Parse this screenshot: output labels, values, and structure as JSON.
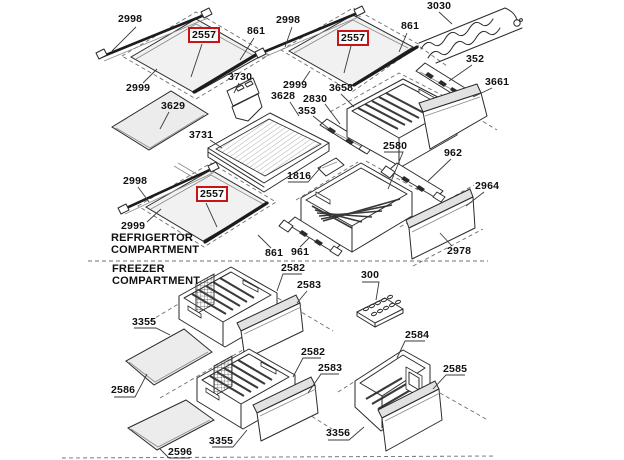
{
  "window": {
    "width": 624,
    "height": 460,
    "background": "#ffffff"
  },
  "diagram": {
    "type": "exploded-parts-diagram",
    "subject": "Refrigerator and freezer compartment shelves, drawers and trim parts",
    "line_color": "#2a2a2a",
    "highlight_color": "#c81414",
    "highlighted_part": "2557",
    "section_labels": [
      {
        "text": "REFRIGERTOR\nCOMPARTMENT",
        "x": 111,
        "y": 232
      },
      {
        "text": "FREEZER\nCOMPARTMENT",
        "x": 112,
        "y": 263
      }
    ],
    "part_labels": [
      {
        "text": "2998",
        "x": 118,
        "y": 14,
        "highlighted": false
      },
      {
        "text": "2557",
        "x": 188,
        "y": 27,
        "highlighted": true
      },
      {
        "text": "861",
        "x": 247,
        "y": 26,
        "highlighted": false
      },
      {
        "text": "3030",
        "x": 427,
        "y": 1,
        "highlighted": false
      },
      {
        "text": "2998",
        "x": 276,
        "y": 15,
        "highlighted": false
      },
      {
        "text": "2557",
        "x": 337,
        "y": 30,
        "highlighted": true
      },
      {
        "text": "861",
        "x": 401,
        "y": 21,
        "highlighted": false
      },
      {
        "text": "352",
        "x": 466,
        "y": 54,
        "highlighted": false
      },
      {
        "text": "3661",
        "x": 485,
        "y": 77,
        "highlighted": false
      },
      {
        "text": "2999",
        "x": 126,
        "y": 83,
        "highlighted": false
      },
      {
        "text": "3730",
        "x": 228,
        "y": 72,
        "highlighted": false
      },
      {
        "text": "2999",
        "x": 283,
        "y": 80,
        "highlighted": false
      },
      {
        "text": "3629",
        "x": 161,
        "y": 101,
        "highlighted": false
      },
      {
        "text": "3628",
        "x": 271,
        "y": 91,
        "highlighted": false
      },
      {
        "text": "3658",
        "x": 329,
        "y": 83,
        "highlighted": false
      },
      {
        "text": "2830",
        "x": 303,
        "y": 94,
        "highlighted": false
      },
      {
        "text": "353",
        "x": 298,
        "y": 106,
        "highlighted": false
      },
      {
        "text": "3731",
        "x": 189,
        "y": 130,
        "highlighted": false
      },
      {
        "text": "2580",
        "x": 383,
        "y": 141,
        "highlighted": false
      },
      {
        "text": "962",
        "x": 444,
        "y": 148,
        "highlighted": false
      },
      {
        "text": "1816",
        "x": 287,
        "y": 171,
        "highlighted": false
      },
      {
        "text": "2964",
        "x": 475,
        "y": 181,
        "highlighted": false
      },
      {
        "text": "2998",
        "x": 123,
        "y": 176,
        "highlighted": false
      },
      {
        "text": "2557",
        "x": 196,
        "y": 186,
        "highlighted": true
      },
      {
        "text": "2999",
        "x": 121,
        "y": 221,
        "highlighted": false
      },
      {
        "text": "2978",
        "x": 447,
        "y": 246,
        "highlighted": false
      },
      {
        "text": "861",
        "x": 265,
        "y": 248,
        "highlighted": false
      },
      {
        "text": "961",
        "x": 291,
        "y": 247,
        "highlighted": false
      },
      {
        "text": "2582",
        "x": 281,
        "y": 263,
        "highlighted": false
      },
      {
        "text": "2583",
        "x": 297,
        "y": 280,
        "highlighted": false
      },
      {
        "text": "300",
        "x": 361,
        "y": 270,
        "highlighted": false
      },
      {
        "text": "3355",
        "x": 132,
        "y": 317,
        "highlighted": false
      },
      {
        "text": "2584",
        "x": 405,
        "y": 330,
        "highlighted": false
      },
      {
        "text": "2586",
        "x": 111,
        "y": 385,
        "highlighted": false
      },
      {
        "text": "2582",
        "x": 301,
        "y": 347,
        "highlighted": false
      },
      {
        "text": "2583",
        "x": 318,
        "y": 363,
        "highlighted": false
      },
      {
        "text": "2585",
        "x": 443,
        "y": 364,
        "highlighted": false
      },
      {
        "text": "3356",
        "x": 326,
        "y": 428,
        "highlighted": false
      },
      {
        "text": "3355",
        "x": 209,
        "y": 436,
        "highlighted": false
      },
      {
        "text": "2596",
        "x": 168,
        "y": 447,
        "highlighted": false
      }
    ]
  }
}
